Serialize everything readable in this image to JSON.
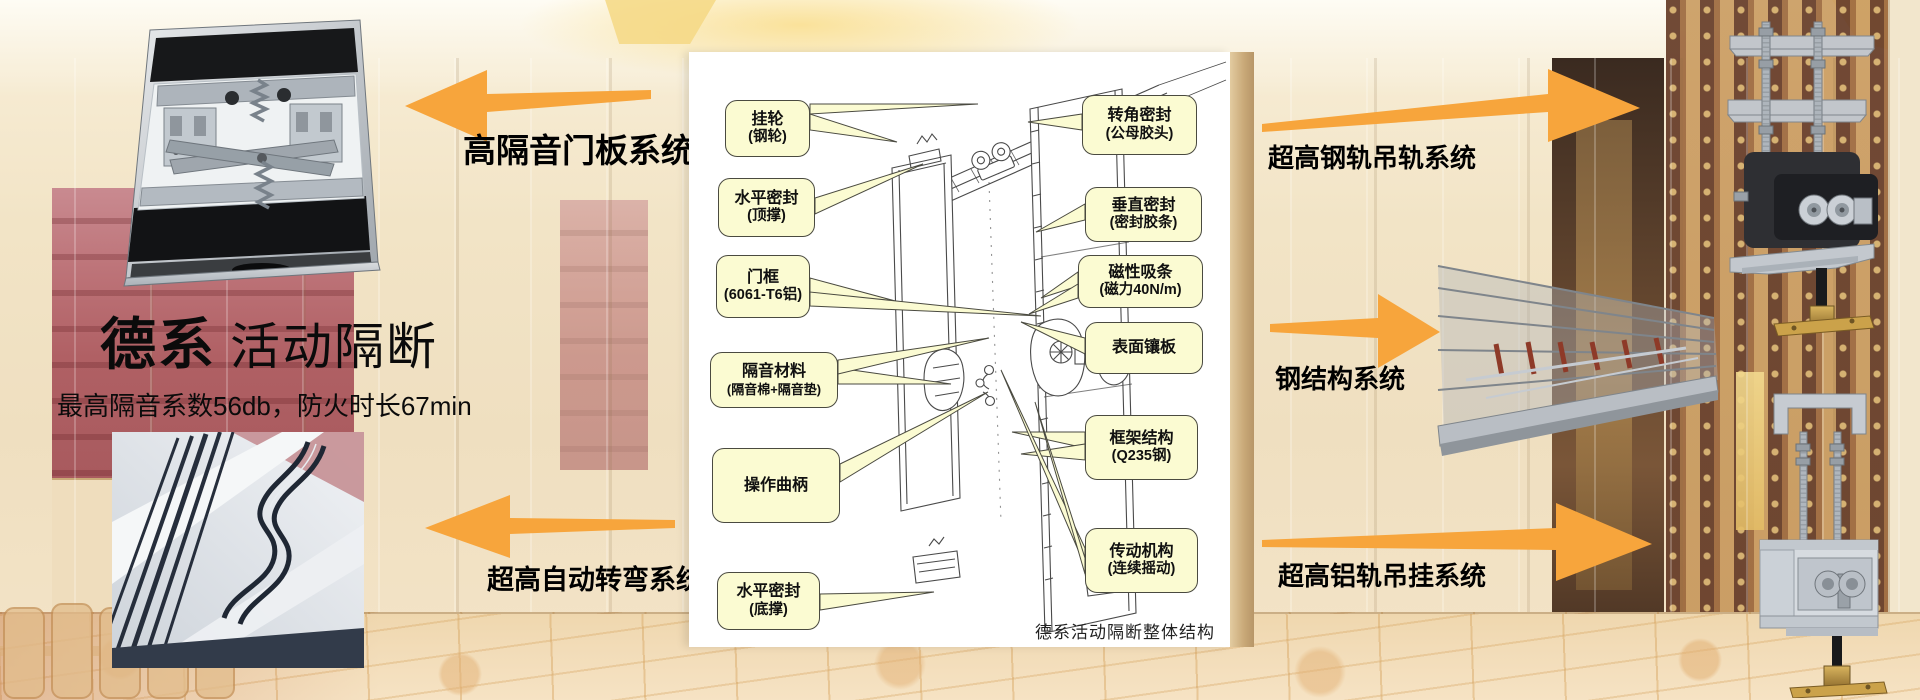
{
  "slide": {
    "title_primary": "德系",
    "title_secondary": "活动隔断",
    "subtitle": "最高隔音系数56db，防火时长67min"
  },
  "system_labels": {
    "door_panel": "高隔音门板系统",
    "auto_turn": "超高自动转弯系统",
    "steel_rail": "超高钢轨吊轨系统",
    "steel_structure": "钢结构系统",
    "alu_rail": "超高铝轨吊挂系统"
  },
  "diagram": {
    "caption": "德系活动隔断整体结构",
    "callouts": {
      "hanging_wheel": {
        "line1": "挂轮",
        "line2": "(钢轮)"
      },
      "h_seal_top": {
        "line1": "水平密封",
        "line2": "(顶撑)"
      },
      "door_frame": {
        "line1": "门框",
        "line2": "(6061-T6铝)"
      },
      "insulation": {
        "line1": "隔音材料",
        "line2": "(隔音棉+隔音垫)"
      },
      "crank": {
        "line1": "操作曲柄",
        "line2": ""
      },
      "h_seal_bottom": {
        "line1": "水平密封",
        "line2": "(底撑)"
      },
      "corner_seal": {
        "line1": "转角密封",
        "line2": "(公母胶头)"
      },
      "v_seal": {
        "line1": "垂直密封",
        "line2": "(密封胶条)"
      },
      "magnetic": {
        "line1": "磁性吸条",
        "line2": "(磁力40N/m)"
      },
      "surface_panel": {
        "line1": "表面镶板",
        "line2": ""
      },
      "frame_structure": {
        "line1": "框架结构",
        "line2": "(Q235钢)"
      },
      "transmission": {
        "line1": "传动机构",
        "line2": "(连续摇动)"
      }
    }
  },
  "colors": {
    "arrow_orange": "#F7A53C",
    "callout_fill": "#FBFBD2",
    "callout_border": "#4A4A40",
    "maroon_wall": "#A85A5E"
  }
}
